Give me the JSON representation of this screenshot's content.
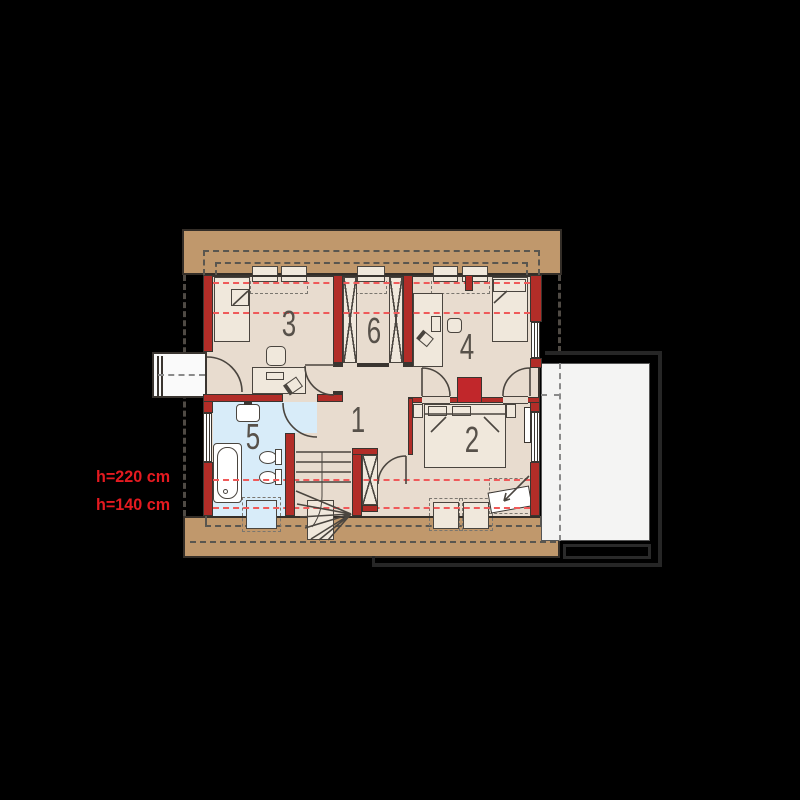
{
  "plan": {
    "title": "attic floor plan",
    "rooms": [
      {
        "number": "1",
        "name": "hall-stairs"
      },
      {
        "number": "2",
        "name": "bedroom-right"
      },
      {
        "number": "3",
        "name": "bedroom-left"
      },
      {
        "number": "4",
        "name": "bedroom-top-right"
      },
      {
        "number": "5",
        "name": "bathroom"
      },
      {
        "number": "6",
        "name": "wardrobe-closet"
      }
    ],
    "height_labels": [
      {
        "text": "h=220 cm"
      },
      {
        "text": "h=140 cm"
      }
    ],
    "colors": {
      "background": "#000000",
      "roof_band": "#c0986c",
      "floor": "#e8dccf",
      "furniture": "#f0e8dc",
      "bathroom": "#d8ecf9",
      "wall_red": "#b22d28",
      "dashed_red": "#ef5a5a",
      "label_red": "#e51a20",
      "garage_white": "#f4f4f3",
      "line_dark": "#4a453f"
    }
  }
}
